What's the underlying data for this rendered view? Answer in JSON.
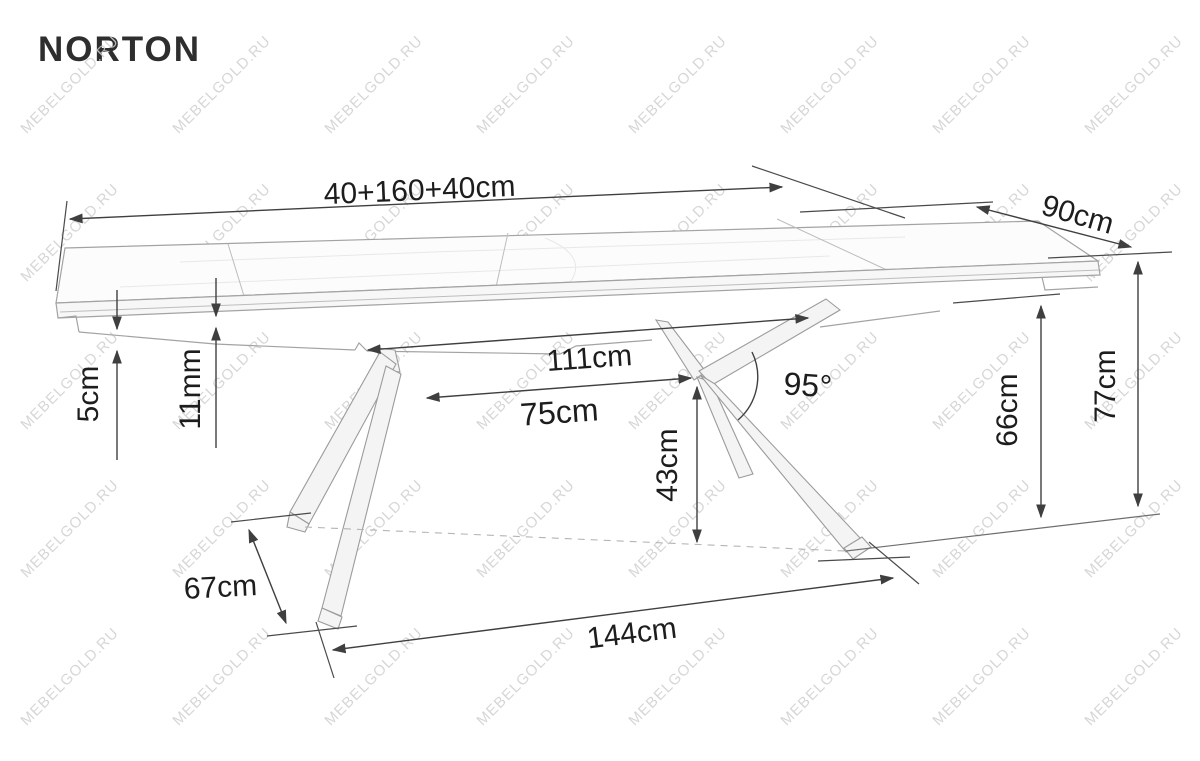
{
  "page": {
    "title": "NORTON"
  },
  "watermark": {
    "text": "MEBELGOLD.RU"
  },
  "dimensions": {
    "total_length": {
      "label": "40+160+40cm"
    },
    "depth": {
      "label": "90cm"
    },
    "top_thickness": {
      "label": "5cm"
    },
    "leaf_step": {
      "label": "11mm"
    },
    "underframe_length": {
      "label": "111cm"
    },
    "leg_top_span": {
      "label": "75cm"
    },
    "leg_angle": {
      "label": "95°"
    },
    "under_clearance": {
      "label": "43cm"
    },
    "apron_height": {
      "label": "66cm"
    },
    "table_height": {
      "label": "77cm"
    },
    "foot_depth": {
      "label": "67cm"
    },
    "foot_span": {
      "label": "144cm"
    }
  }
}
